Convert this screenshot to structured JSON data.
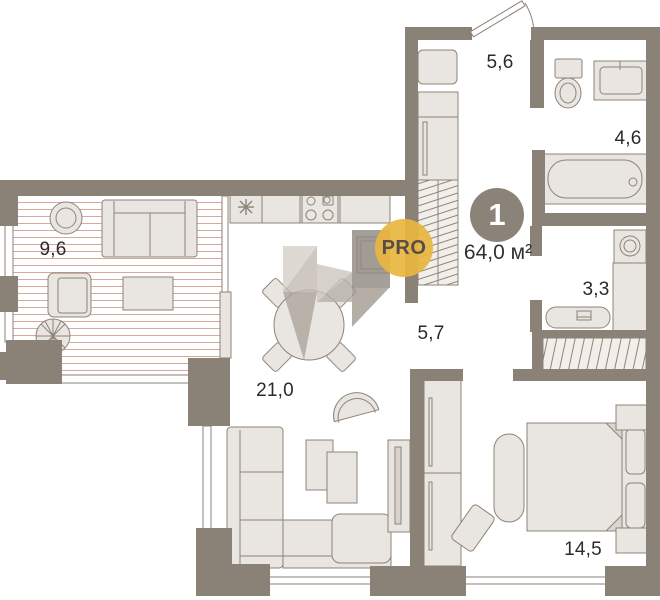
{
  "plan": {
    "badge": {
      "rooms_count": "1",
      "total_area": "64,0 м²"
    },
    "brand": {
      "label": "PRO"
    },
    "rooms": [
      {
        "name": "loggia",
        "area": "9,6"
      },
      {
        "name": "entry-hall",
        "area": "5,6"
      },
      {
        "name": "bathroom",
        "area": "4,6"
      },
      {
        "name": "wc-laundry",
        "area": "3,3"
      },
      {
        "name": "corridor",
        "area": "5,7"
      },
      {
        "name": "kitchen-living",
        "area": "21,0"
      },
      {
        "name": "bedroom",
        "area": "14,5"
      }
    ],
    "colors": {
      "wall": "#8a8177",
      "furniture_fill": "#e9e5e0",
      "floor": "#ffffff",
      "loggia_stripe": "#d9a898",
      "badge_circle": "#8c8378",
      "accent_pro": "#e9b844",
      "label_text": "#2d2a27"
    }
  }
}
